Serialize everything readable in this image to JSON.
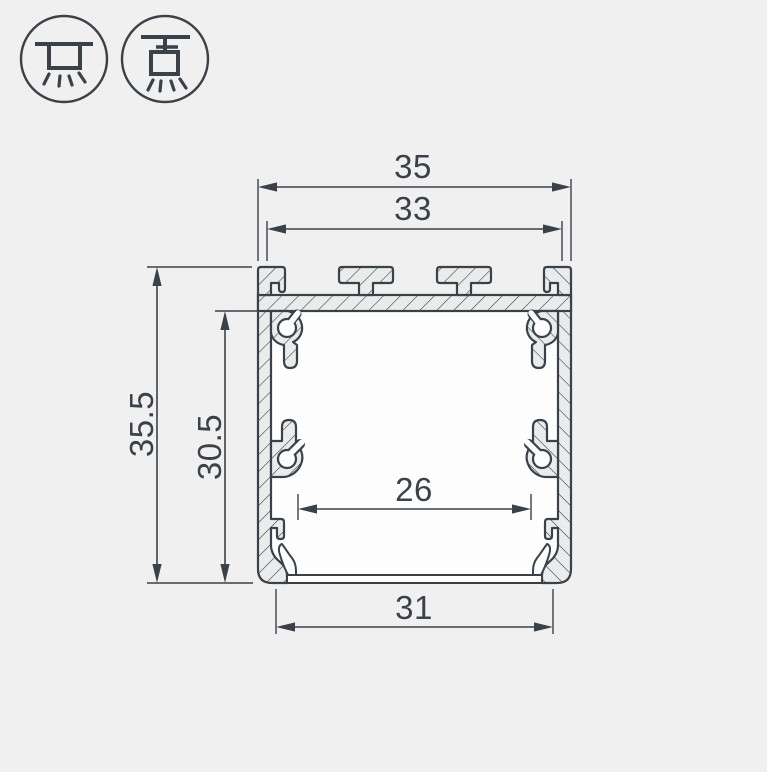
{
  "title": "Aluminium LED profile cross-section technical drawing",
  "colors": {
    "background": "#f0f0f0",
    "line": "#3a4149",
    "material_fill": "#eaecec",
    "cavity_fill": "#fdfdfd"
  },
  "mounting_icons": [
    {
      "name": "surface-mount"
    },
    {
      "name": "pendant-mount"
    }
  ],
  "dimensions": {
    "top_width": "35",
    "top_inner_width": "33",
    "outer_height": "35.5",
    "inner_height": "30.5",
    "inner_width": "26",
    "bottom_width": "31"
  }
}
